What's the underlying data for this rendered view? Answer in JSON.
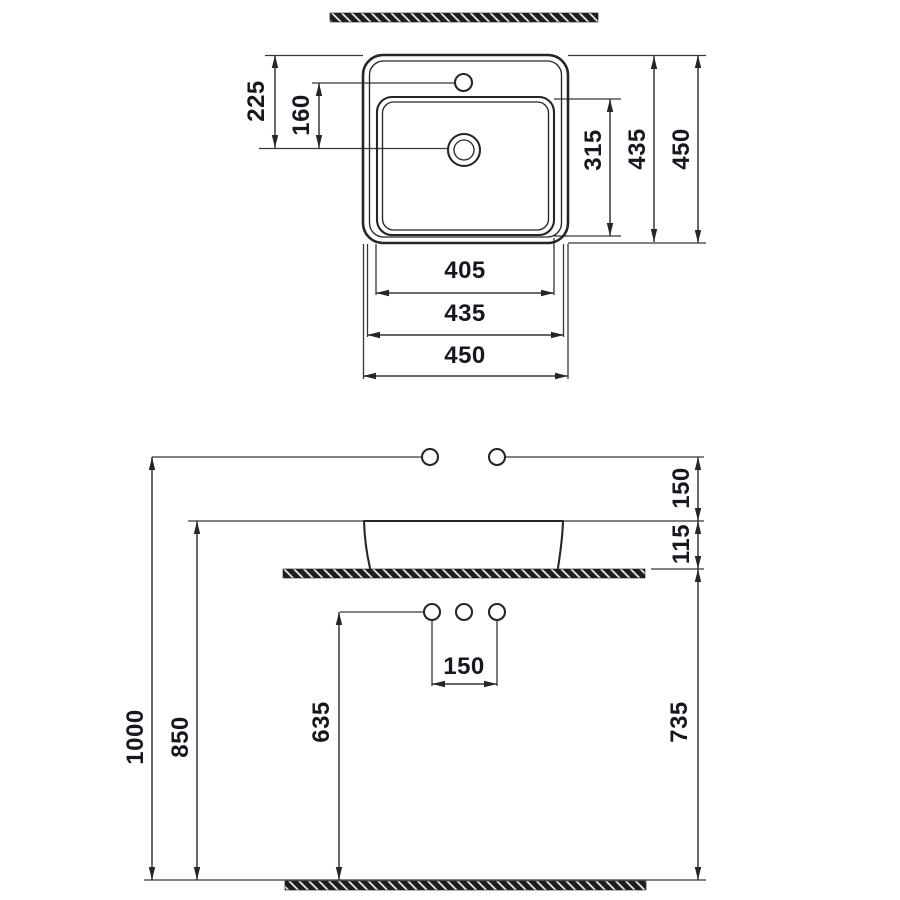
{
  "colors": {
    "line": "#26262a",
    "line_thin": "#36363c",
    "text": "#17181f",
    "hatch_dark": "#1e1e22",
    "hatch_light": "#f4f4f4",
    "background": "#ffffff"
  },
  "top_view": {
    "dims": {
      "v225": "225",
      "v160": "160",
      "v315": "315",
      "v435": "435",
      "v450": "450",
      "h405": "405",
      "h435": "435",
      "h450": "450"
    }
  },
  "front_view": {
    "dims": {
      "v1000": "1000",
      "v850": "850",
      "v635": "635",
      "v735": "735",
      "v150": "150",
      "v115": "115",
      "h150": "150"
    }
  }
}
